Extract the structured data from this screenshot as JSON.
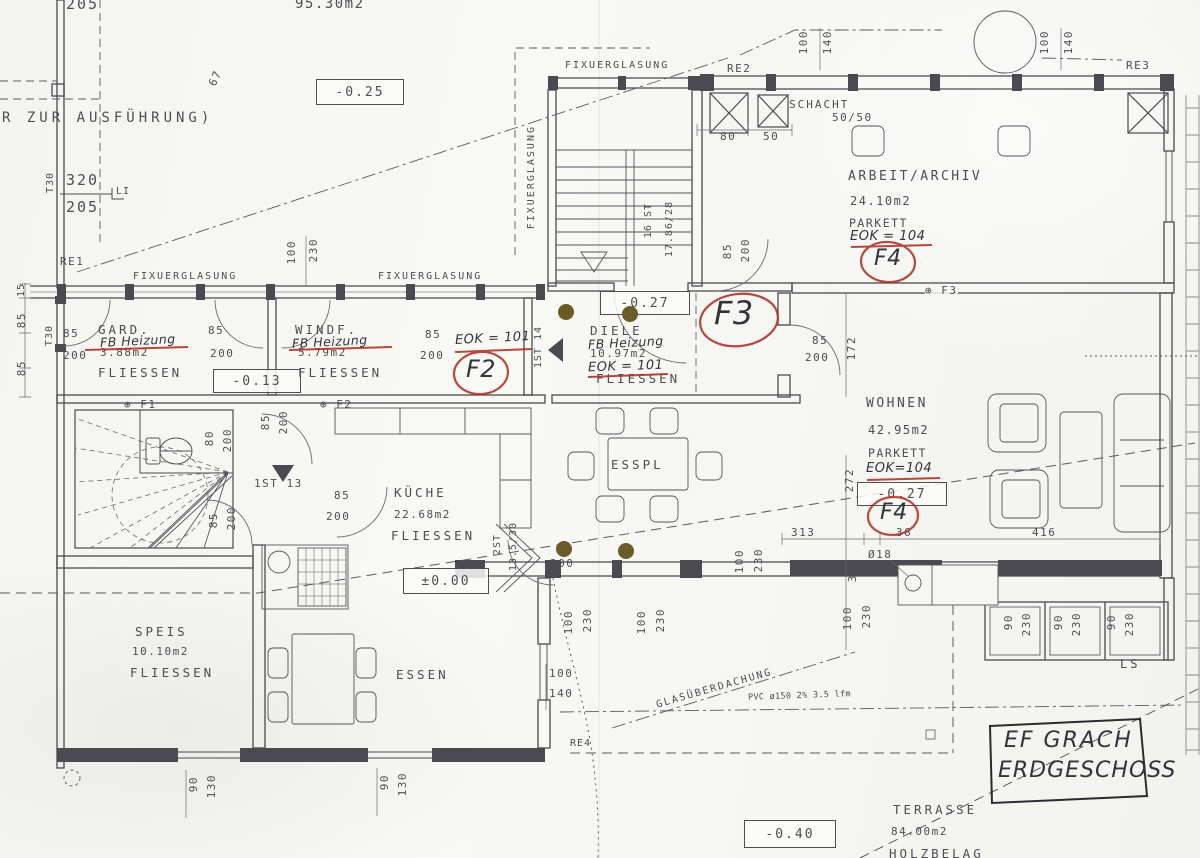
{
  "document": {
    "note": "R ZUR AUSFÜHRUNG)",
    "upper_floor_area": "95.30m2",
    "title_line1": "EF GRACH",
    "title_line2": "ERDGESCHOSS"
  },
  "glazing": {
    "label": "FIXUERGLASUNG"
  },
  "levels": {
    "upper": "-0.25",
    "entry": "-0.13",
    "hall": "-0.27",
    "living": "-0.27",
    "kitchen": "±0.00",
    "terrace": "-0.40"
  },
  "rooms": {
    "arbeit": {
      "name": "ARBEIT/ARCHIV",
      "area": "24.10m2",
      "floor": "PARKETT",
      "hand_note": "EOK = 104"
    },
    "gard": {
      "name": "GARD.",
      "hand_note": "FB Heizung",
      "area": "3.88m2",
      "floor": "FLIESSEN"
    },
    "windf": {
      "name": "WINDF.",
      "hand_note": "FB Heizung",
      "area": "5.79m2",
      "floor": "FLIESSEN"
    },
    "diele": {
      "name": "DIELE",
      "hand_note": "FB Heizung",
      "area": "10.97m2",
      "floor": "FLIESSEN"
    },
    "wohnen": {
      "name": "WOHNEN",
      "area": "42.95m2",
      "floor": "PARKETT",
      "hand_note": "EOK=104"
    },
    "kueche": {
      "name": "KÜCHE",
      "area": "22.68m2",
      "floor": "FLIESSEN"
    },
    "speis": {
      "name": "SPEIS",
      "area": "10.10m2",
      "floor": "FLIESSEN"
    },
    "essen": {
      "name": "ESSEN"
    },
    "esspl": {
      "name": "ESSPL"
    },
    "terrasse": {
      "name": "TERRASSE",
      "area": "84.00m2",
      "floor": "HOLZBELAG"
    }
  },
  "schacht": {
    "label": "SCHACHT",
    "size": "50/50"
  },
  "stairs": {
    "main_steps": "16 ST",
    "main_rise": "17.86/28",
    "hall_step": "1ST 14",
    "lower_step": "1ST 13",
    "kitchen_steps": "2ST",
    "kitchen_rise": "13.5/30"
  },
  "ref": {
    "re1": "RE1",
    "re2": "RE2",
    "re3": "RE3",
    "re4": "RE4",
    "f1": "⊕ F1",
    "f2": "⊕ F2",
    "f3": "⊕ F3"
  },
  "hand": {
    "f2": "F2",
    "f3": "F3",
    "f4": "F4",
    "eok101": "EOK = 101"
  },
  "canopy": {
    "glas": "GLASÜBERDACHUNG",
    "pipe": "PVC ø150 2% 3.5 lfm",
    "ls": "LS"
  },
  "dims": {
    "v15": "15",
    "v36": "36",
    "v50": "50",
    "v67": "67",
    "v80": "80",
    "v85": "85",
    "v90": "90",
    "v100": "100",
    "v130": "130",
    "v140": "140",
    "v172": "172",
    "v200": "200",
    "v205": "205",
    "v230": "230",
    "v272": "272",
    "v313": "313",
    "v320": "320",
    "v416": "416",
    "t30": "T30",
    "li": "LI",
    "dia18": "Ø18"
  },
  "colors": {
    "ink": "#4d4d53",
    "red_pen": "#b03328",
    "dot_brown": "#6b5b26"
  }
}
